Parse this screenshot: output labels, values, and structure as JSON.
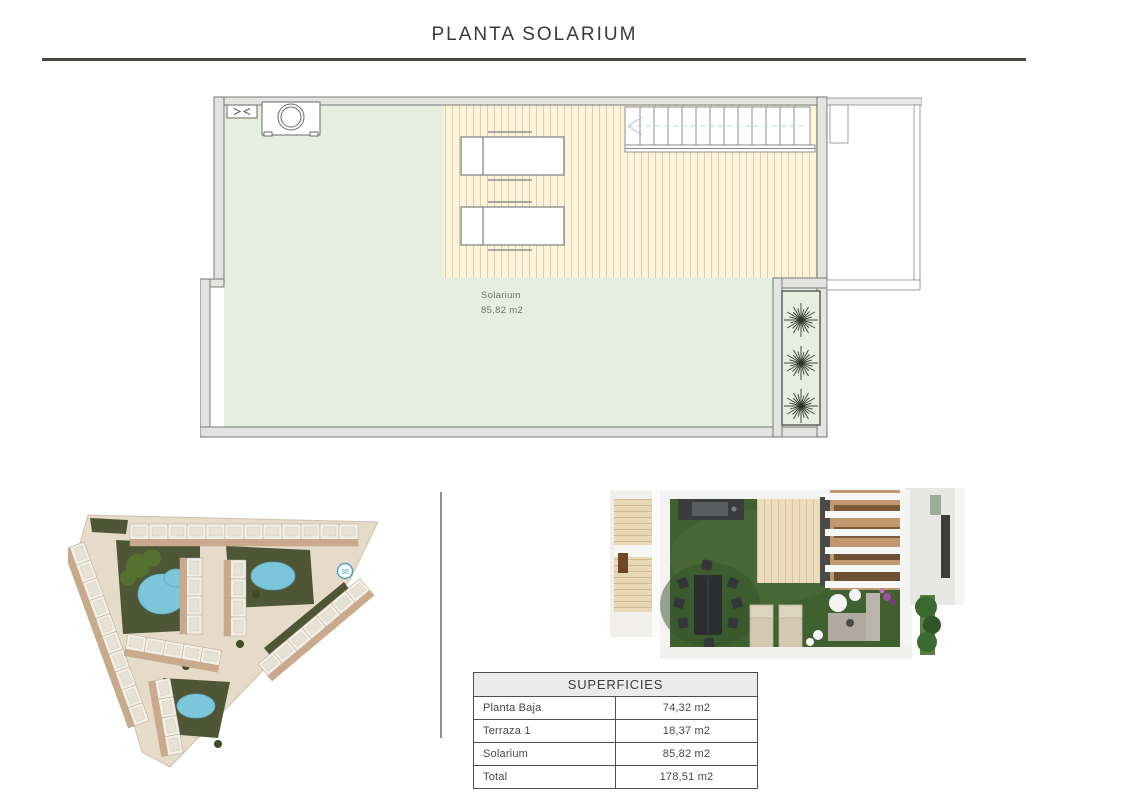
{
  "page": {
    "title": "PLANTA SOLARIUM"
  },
  "floor_plan": {
    "room_label": "Solarium",
    "room_area": "85,82 m2"
  },
  "site_plan": {
    "unit_marker": "36"
  },
  "superficies_table": {
    "header": "SUPERFICIES",
    "rows": [
      {
        "label": "Planta Baja",
        "value": "74,32 m2"
      },
      {
        "label": "Terraza 1",
        "value": "18,37 m2"
      },
      {
        "label": "Solarium",
        "value": "85,82 m2"
      },
      {
        "label": "Total",
        "value": "178,51 m2"
      }
    ]
  },
  "colors": {
    "rule_dark": "#4b4841",
    "wall_gray": "#e3e3e1",
    "floor_green": "#e6efdf",
    "deck_beige": "#fbf4db",
    "marker_teal": "#45a3bd",
    "pool_blue": "#7cc6da",
    "grass_green": "#3f6130"
  }
}
